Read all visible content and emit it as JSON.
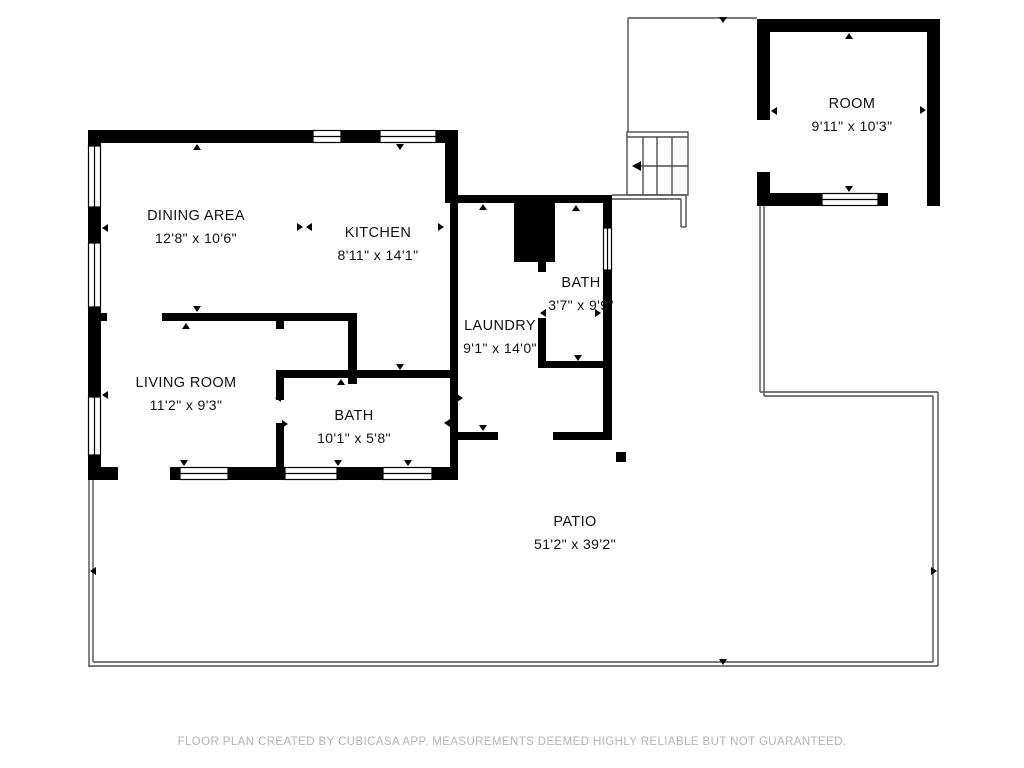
{
  "plan": {
    "app_attribution": "CubiCasa",
    "colors": {
      "wall": "#000000",
      "thin_line": "#4d4d4d",
      "background": "#ffffff",
      "footer_text": "#b3b3b3"
    },
    "rooms": [
      {
        "id": "dining",
        "name": "DINING AREA",
        "dims": "12'8\" x 10'6\""
      },
      {
        "id": "kitchen",
        "name": "KITCHEN",
        "dims": "8'11\" x 14'1\""
      },
      {
        "id": "bath-upper",
        "name": "BATH",
        "dims": "3'7\" x 9'9\""
      },
      {
        "id": "laundry",
        "name": "LAUNDRY",
        "dims": "9'1\" x 14'0\""
      },
      {
        "id": "living",
        "name": "LIVING ROOM",
        "dims": "11'2\" x 9'3\""
      },
      {
        "id": "bath-lower",
        "name": "BATH",
        "dims": "10'1\" x 5'8\""
      },
      {
        "id": "room",
        "name": "ROOM",
        "dims": "9'11\" x 10'3\""
      },
      {
        "id": "patio",
        "name": "PATIO",
        "dims": "51'2\" x 39'2\""
      }
    ],
    "footer": {
      "text": "FLOOR PLAN CREATED BY CUBICASA APP. MEASUREMENTS DEEMED HIGHLY RELIABLE BUT NOT GUARANTEED."
    }
  }
}
